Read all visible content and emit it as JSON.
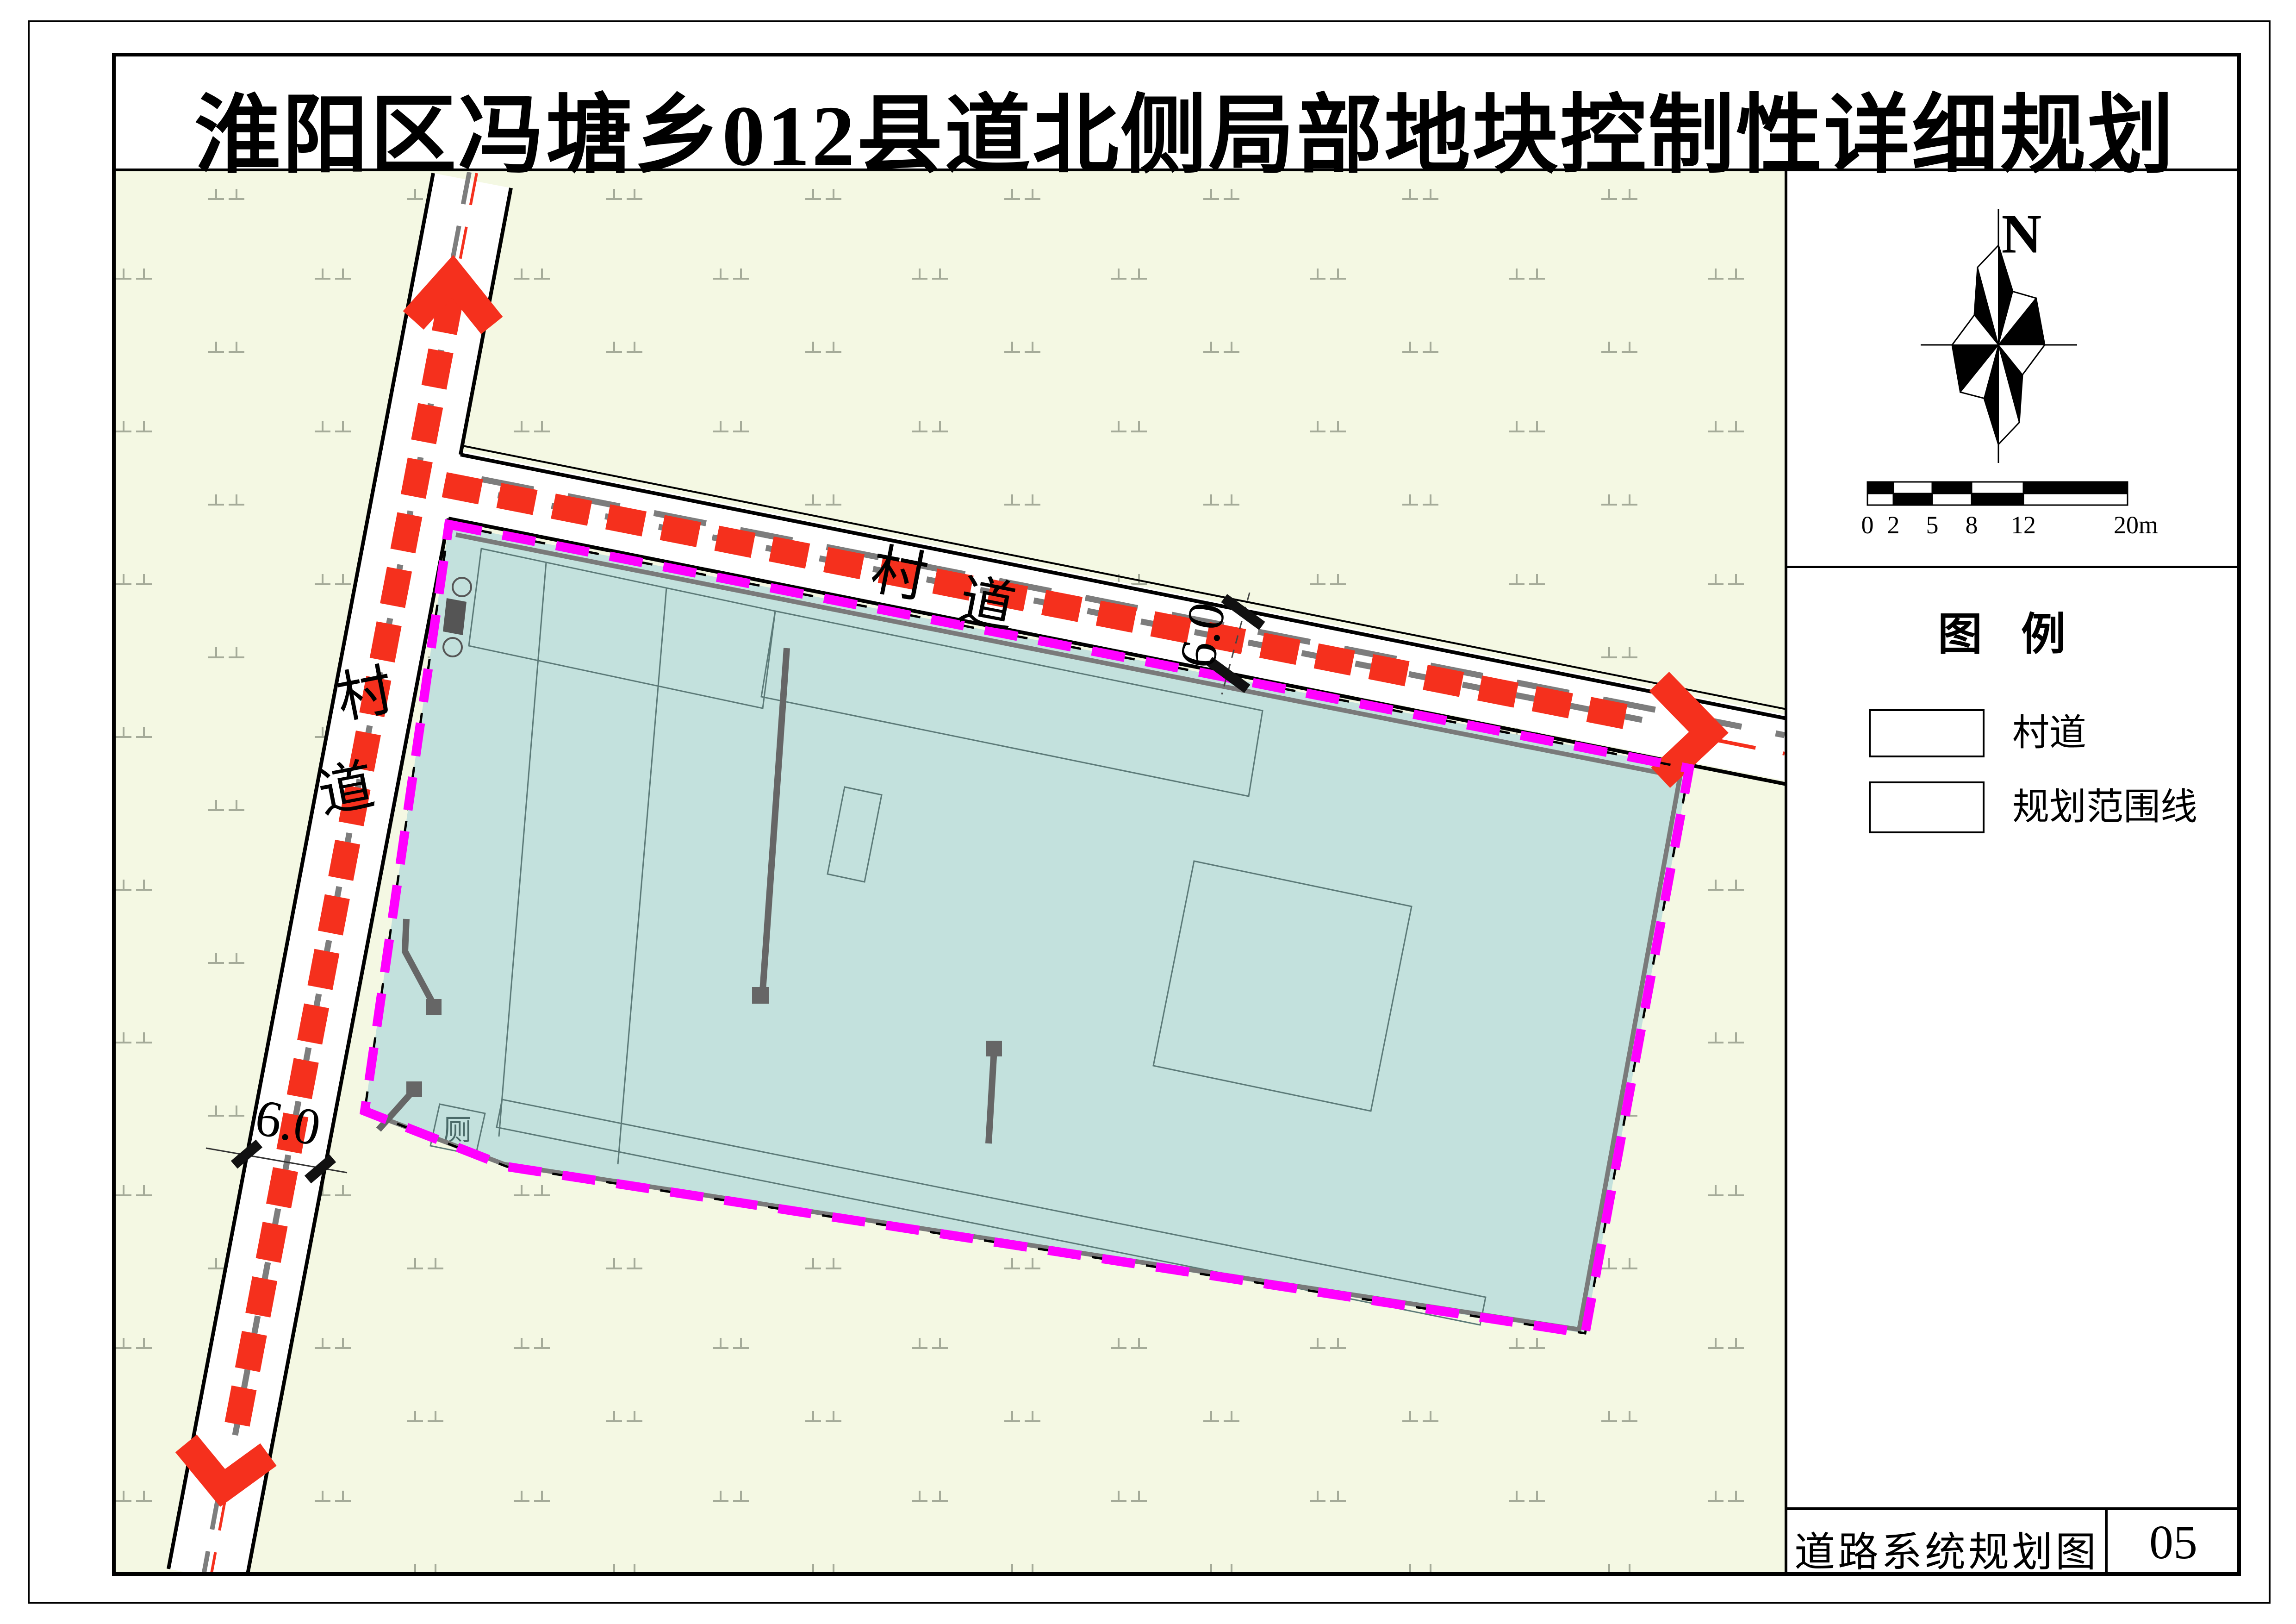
{
  "title": "淮阳区冯塘乡012县道北侧局部地块控制性详细规划",
  "compass": {
    "north_label": "N"
  },
  "scale_bar": {
    "labels": [
      "0",
      "2",
      "5",
      "8",
      "12",
      "20m"
    ]
  },
  "legend": {
    "heading": "图  例",
    "items": [
      {
        "label": "村道"
      },
      {
        "label": "规划范围线"
      }
    ]
  },
  "title_block": {
    "drawing_name": "道路系统规划图",
    "sheet_number": "05"
  },
  "map": {
    "north_road": {
      "name_chars": [
        "村",
        "道"
      ],
      "width_label": "6.0"
    },
    "west_road": {
      "name_chars": [
        "村",
        "道"
      ],
      "width_label": "6.0"
    },
    "toilet_label": "厕"
  },
  "colors": {
    "road_red": "#f5301d",
    "boundary_magenta": "#ff00ff",
    "planning_area_fill": "#c3e1dd",
    "map_background": "#f4f8e3"
  }
}
